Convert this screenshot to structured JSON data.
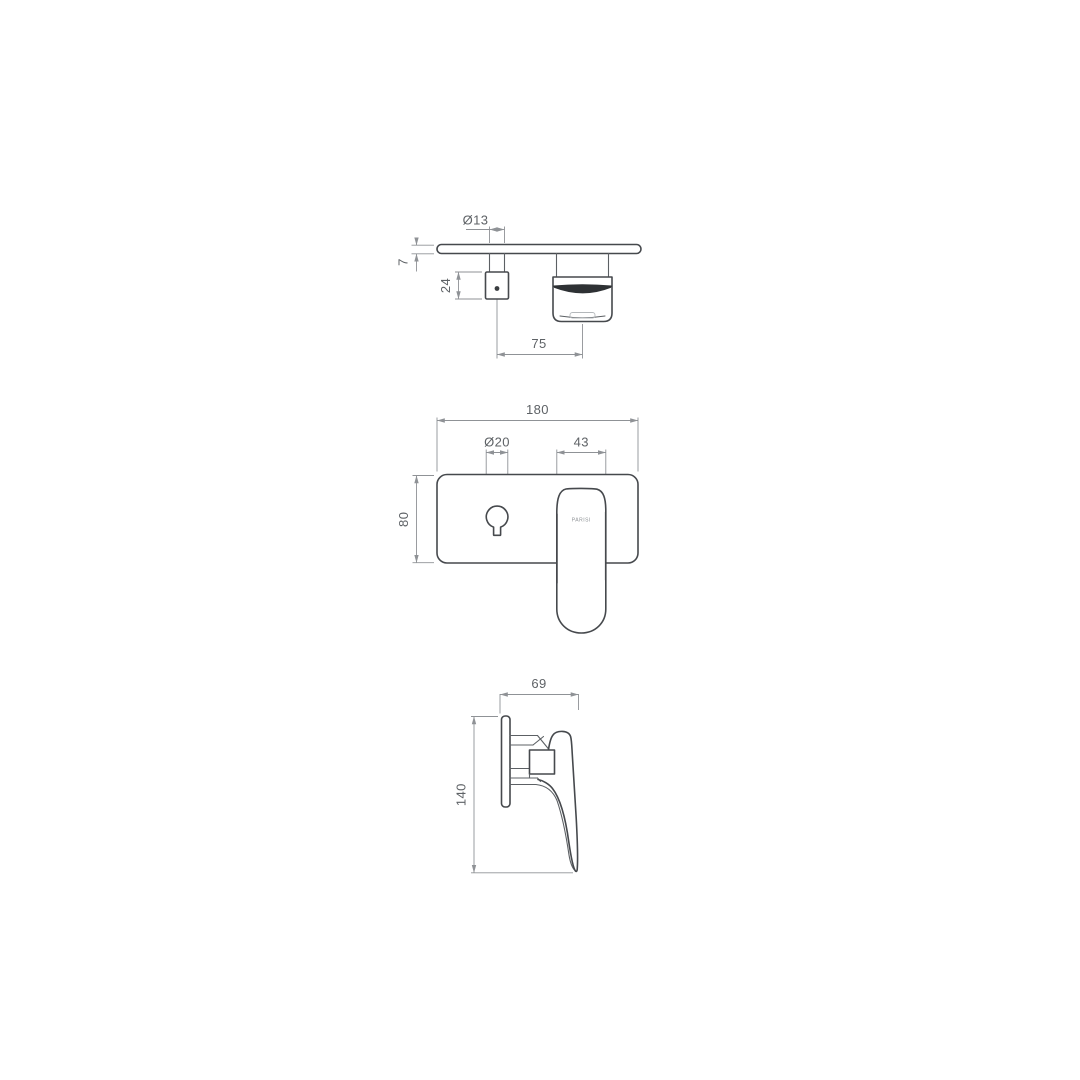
{
  "page": {
    "background": "#ffffff"
  },
  "drawing": {
    "views": {
      "top": {
        "dims": {
          "spout_diameter": "Ø13",
          "plate_thickness": "7",
          "spout_block_depth": "24",
          "spout_to_handle_centres": "75"
        }
      },
      "front": {
        "dims": {
          "plate_width": "180",
          "hole_diameter": "Ø20",
          "handle_width": "43",
          "plate_height": "80"
        },
        "handle_label": "PARISI"
      },
      "side": {
        "dims": {
          "depth": "69",
          "overall_height": "140"
        }
      }
    },
    "colors": {
      "object_line": "#46494d",
      "dimension_line": "#8f9296",
      "label_text": "#5e6266",
      "background": "#ffffff"
    }
  }
}
